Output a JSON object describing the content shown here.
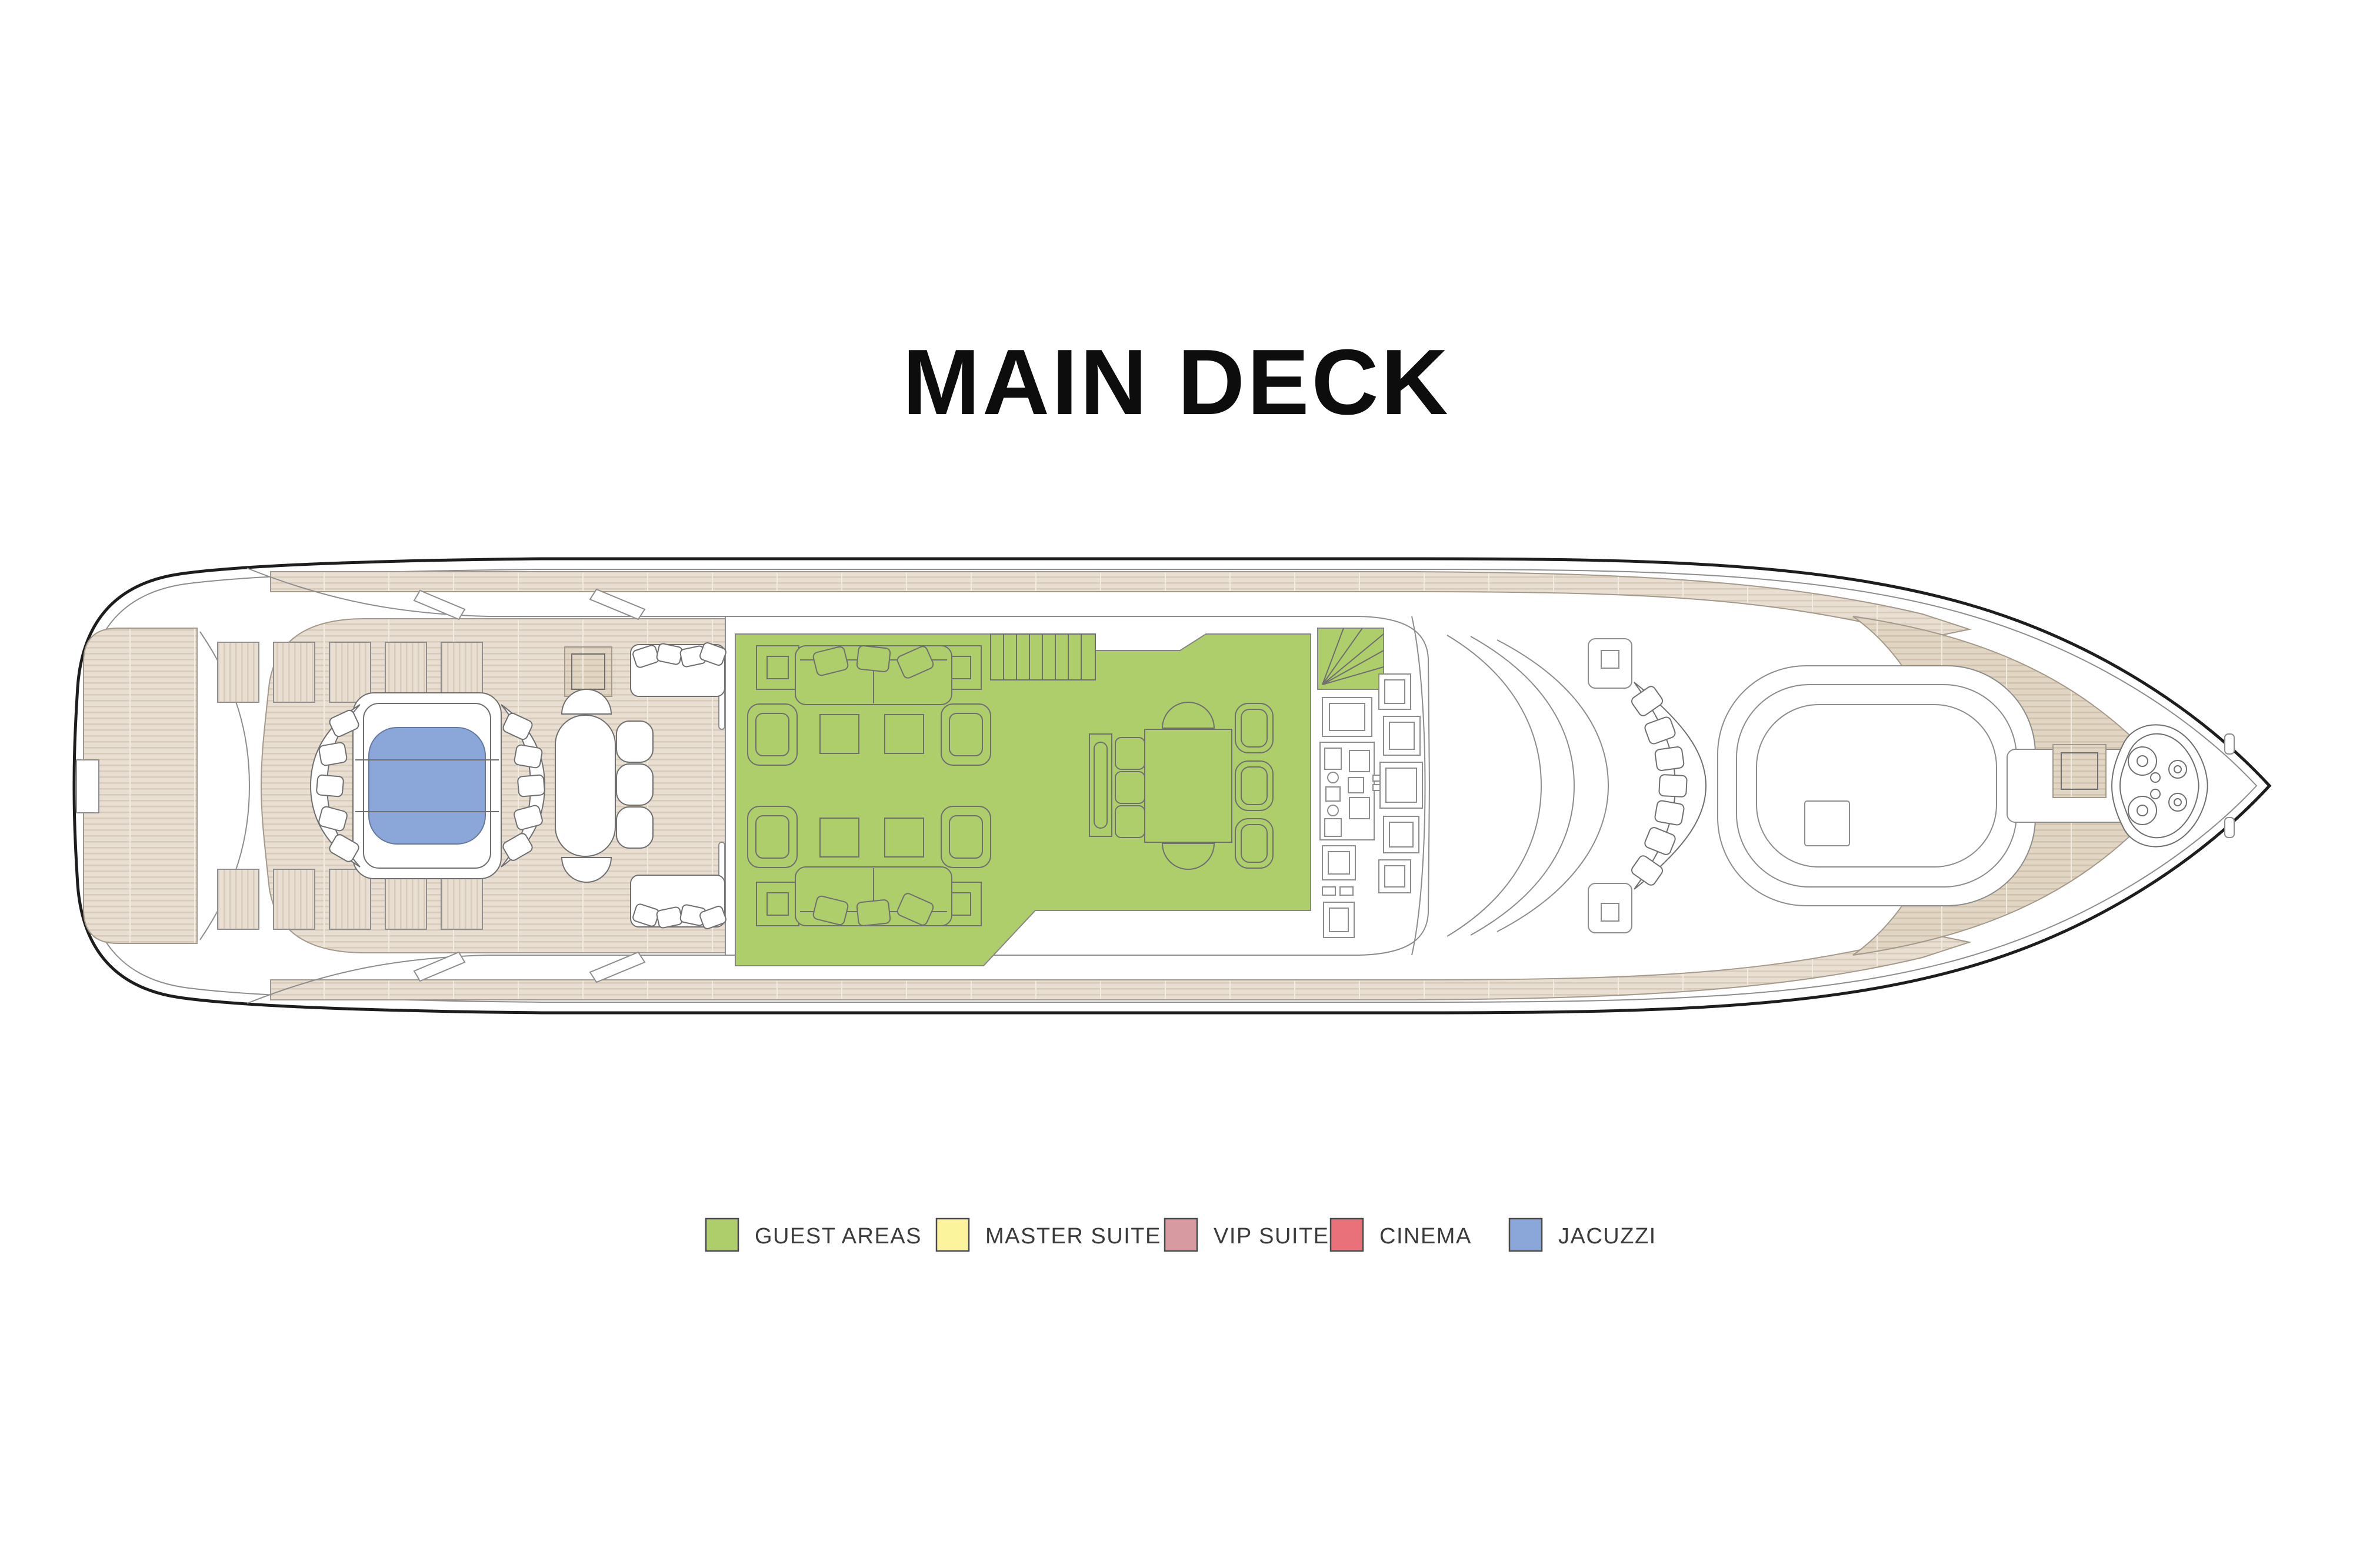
{
  "title": "MAIN DECK",
  "legend": {
    "items": [
      {
        "id": "guest-areas",
        "label": "GUEST AREAS",
        "color": "#aecd6b"
      },
      {
        "id": "master-suite",
        "label": "MASTER SUITE",
        "color": "#fbf49c"
      },
      {
        "id": "vip-suite",
        "label": "VIP SUITE",
        "color": "#d69aa0"
      },
      {
        "id": "cinema",
        "label": "CINEMA",
        "color": "#e8717a"
      },
      {
        "id": "jacuzzi",
        "label": "JACUZZI",
        "color": "#8ba7d9"
      }
    ]
  },
  "plan": {
    "deck_name": "MAIN DECK",
    "orientation": "bow-right",
    "highlighted_zones": [
      {
        "id": "guest-areas",
        "color": "#aecd6b"
      },
      {
        "id": "jacuzzi",
        "color": "#8ba7d9"
      }
    ],
    "features": [
      "swim-platform",
      "transom-gate",
      "stern-locker-slats",
      "stern-hatch",
      "aft-deck",
      "jacuzzi-pool",
      "jacuzzi-platform",
      "curved-jacuzzi-sofas",
      "aft-oval-table",
      "aft-deck-chairs",
      "aft-bench-seats",
      "side-deck-walkways",
      "main-salon",
      "salon-sofas",
      "salon-armchairs",
      "salon-coffee-tables",
      "salon-side-tables",
      "salon-staircase",
      "spiral-staircase",
      "dining-table",
      "dining-chairs",
      "sideboard",
      "galley-pantry-units",
      "wheelhouse-windshield",
      "foredeck-side-tables",
      "crescent-sofa",
      "sun-pad",
      "bow-deck",
      "bow-hatch",
      "anchor-windlass",
      "bow-cleats"
    ]
  },
  "colors": {
    "background": "#ffffff",
    "text": "#3b3b3b",
    "title": "#0d0d0d",
    "hull": "#1d1d1d",
    "line": "#8d8d8d",
    "furniture": "#6f6f6f",
    "teak": "#e8dfd2",
    "teak-stripe": "#d8cbba",
    "teak2": "#e1d5c4",
    "teak2-stripe": "#d0c2ac",
    "teak-edge": "#a39a8b",
    "green": "#aecd6b",
    "blue": "#8ba7d9",
    "pool-stroke": "#64799e"
  }
}
